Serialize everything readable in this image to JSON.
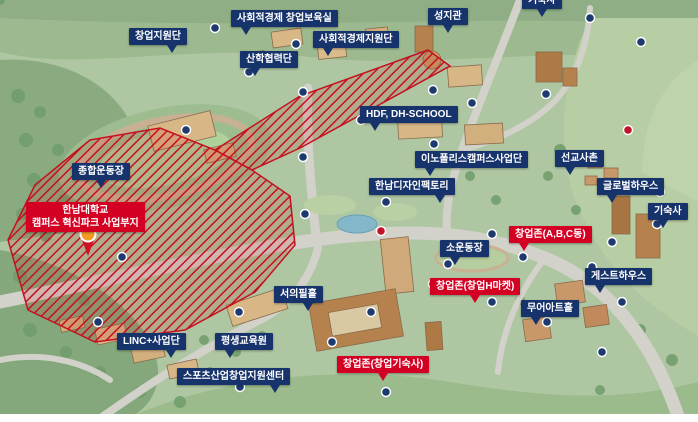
{
  "colors": {
    "navy": "#17336b",
    "red": "#d40023",
    "label_text": "#ffffff",
    "zone_red": "#c5101f",
    "marker_navy": "#1d3a6f",
    "marker_red": "#c01228"
  },
  "labels": {
    "soc_incubator": "사회적경제 창업보육실",
    "soc_support": "사회적경제지원단",
    "seongjigwan": "성지관",
    "dorm_top": "기숙사",
    "startup_support": "창업지원단",
    "sanhak": "산학협력단",
    "hdf_school": "HDF, DH-SCHOOL",
    "innopolis": "이노폴리스캠퍼스사업단",
    "design_factory": "한남디자인팩토리",
    "missionary_village": "선교사촌",
    "global_house": "글로벌하우스",
    "dorm_right": "기숙사",
    "main_stadium": "종합운동장",
    "small_field": "소운동장",
    "guest_house": "게스트하우스",
    "moore_art_hall": "무어아트홀",
    "seouipil_hall": "서의필홀",
    "linc": "LINC+사업단",
    "lifelong_edu": "평생교육원",
    "sports_startup_center": "스포츠산업창업지원센터",
    "innovation_park_line1": "한남대학교",
    "innovation_park_line2": "캠퍼스 혁신파크 사업부지",
    "zone_abc": "창업존(A,B,C동)",
    "zone_h_market": "창업존(창업H마켓)",
    "zone_dorm": "창업존(창업기숙사)"
  }
}
